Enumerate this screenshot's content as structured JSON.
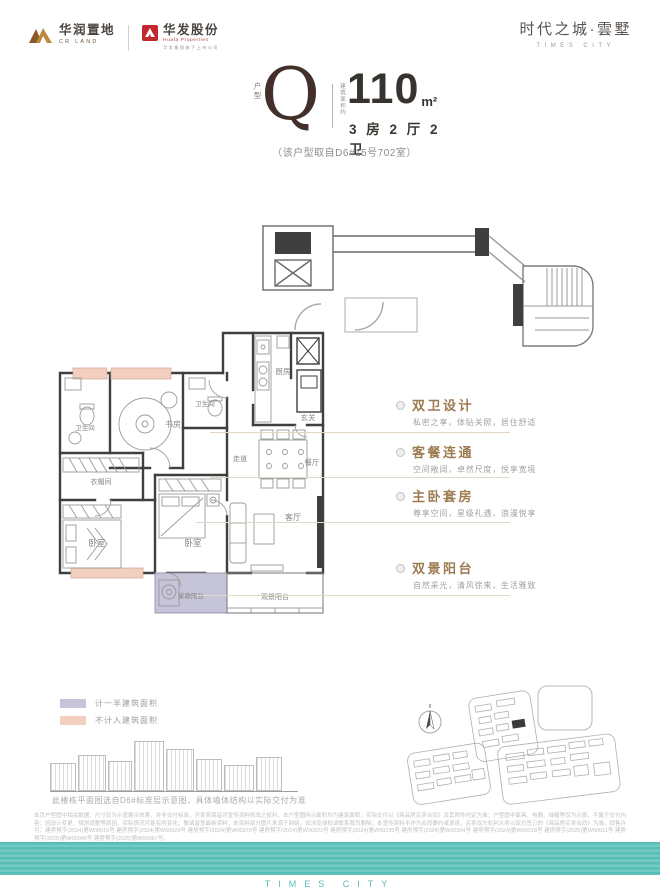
{
  "brand": {
    "crland_cn": "华润置地",
    "crland_en": "CR LAND",
    "huafa_cn": "华发股份",
    "huafa_en": "Huafa Properties",
    "huafa_sub": "华发集团旗下上市公司",
    "project_cn": "时代之城·雲墅",
    "project_en": "TIMES CITY"
  },
  "unit": {
    "type_label": "户型",
    "type_code": "Q",
    "area_note": "建筑面积约",
    "area_value": "110",
    "area_unit": "m²",
    "rooms_summary": "3 房 2 厅 2 卫",
    "source_note": "（该户型取自D6#15号702室）"
  },
  "floorplan": {
    "rooms": [
      {
        "label": "卫生间"
      },
      {
        "label": "书房"
      },
      {
        "label": "卫生间"
      },
      {
        "label": "衣帽间"
      },
      {
        "label": "卧室"
      },
      {
        "label": "卧室"
      },
      {
        "label": "走道"
      },
      {
        "label": "厨房"
      },
      {
        "label": "玄关"
      },
      {
        "label": "餐厅"
      },
      {
        "label": "客厅"
      },
      {
        "label": "家政阳台"
      },
      {
        "label": "观景阳台"
      }
    ]
  },
  "features": [
    {
      "title": "双卫设计",
      "desc": "私密之享，体贴关照，居住舒适"
    },
    {
      "title": "客餐连通",
      "desc": "空间敞阔，卓然尺度，悦享宽境"
    },
    {
      "title": "主卧套房",
      "desc": "尊享空间，星级礼遇，浪漫悦享"
    },
    {
      "title": "双景阳台",
      "desc": "自然采光，清风徐来，生活雅致"
    }
  ],
  "legend": [
    {
      "label": "计一半建筑面积",
      "color": "#c6c4d8"
    },
    {
      "label": "不计入建筑面积",
      "color": "#f3cfc0"
    }
  ],
  "site_note": "此楼栋平面图选自D6#标准层示意图，具体墙体结构以实际交付为准",
  "disclaimer": "本页户型图中相关数据、尺寸仅为示意展示效果，并非交付标准，开发商保留对宣传资料修改之权利，本户型图所示面积均为建筑面积，实际交付以《商品房买卖合同》及其附件约定为准；户型图中家具、电器、绿植等仅为示意，不属于交付内容；因设计变更、规划调整等原因，实际情况可能有所变化，敬请留意最新资料；本资料部分图片来源于网络，如涉及侵权请联系我司删除；本宣传资料不作为合同要约或承诺，买卖双方权利义务以双方签订的《商品房买卖合同》为准。销售许可：建房预字(2024)第W00016号 建房预字(2024)第W00029号 建房预字(2024)第W00070号 建房预字(2024)第W00223号 建房预字(2024)第W00235号 建房预字(2024)第W00304号 建房预字(2024)第W00318号 建房预字(2025)第W00011号 建房预字(2025)第W00046号 建房预字(2025)第W00067号。",
  "footer": {
    "brand_en": "TIMES CITY"
  },
  "colors": {
    "accent": "#9c7b50",
    "footer_teal": "#58bdb5",
    "half_area": "#c6c4d8",
    "excluded_area": "#f3cfc0",
    "wall": "#3f3f3f"
  }
}
